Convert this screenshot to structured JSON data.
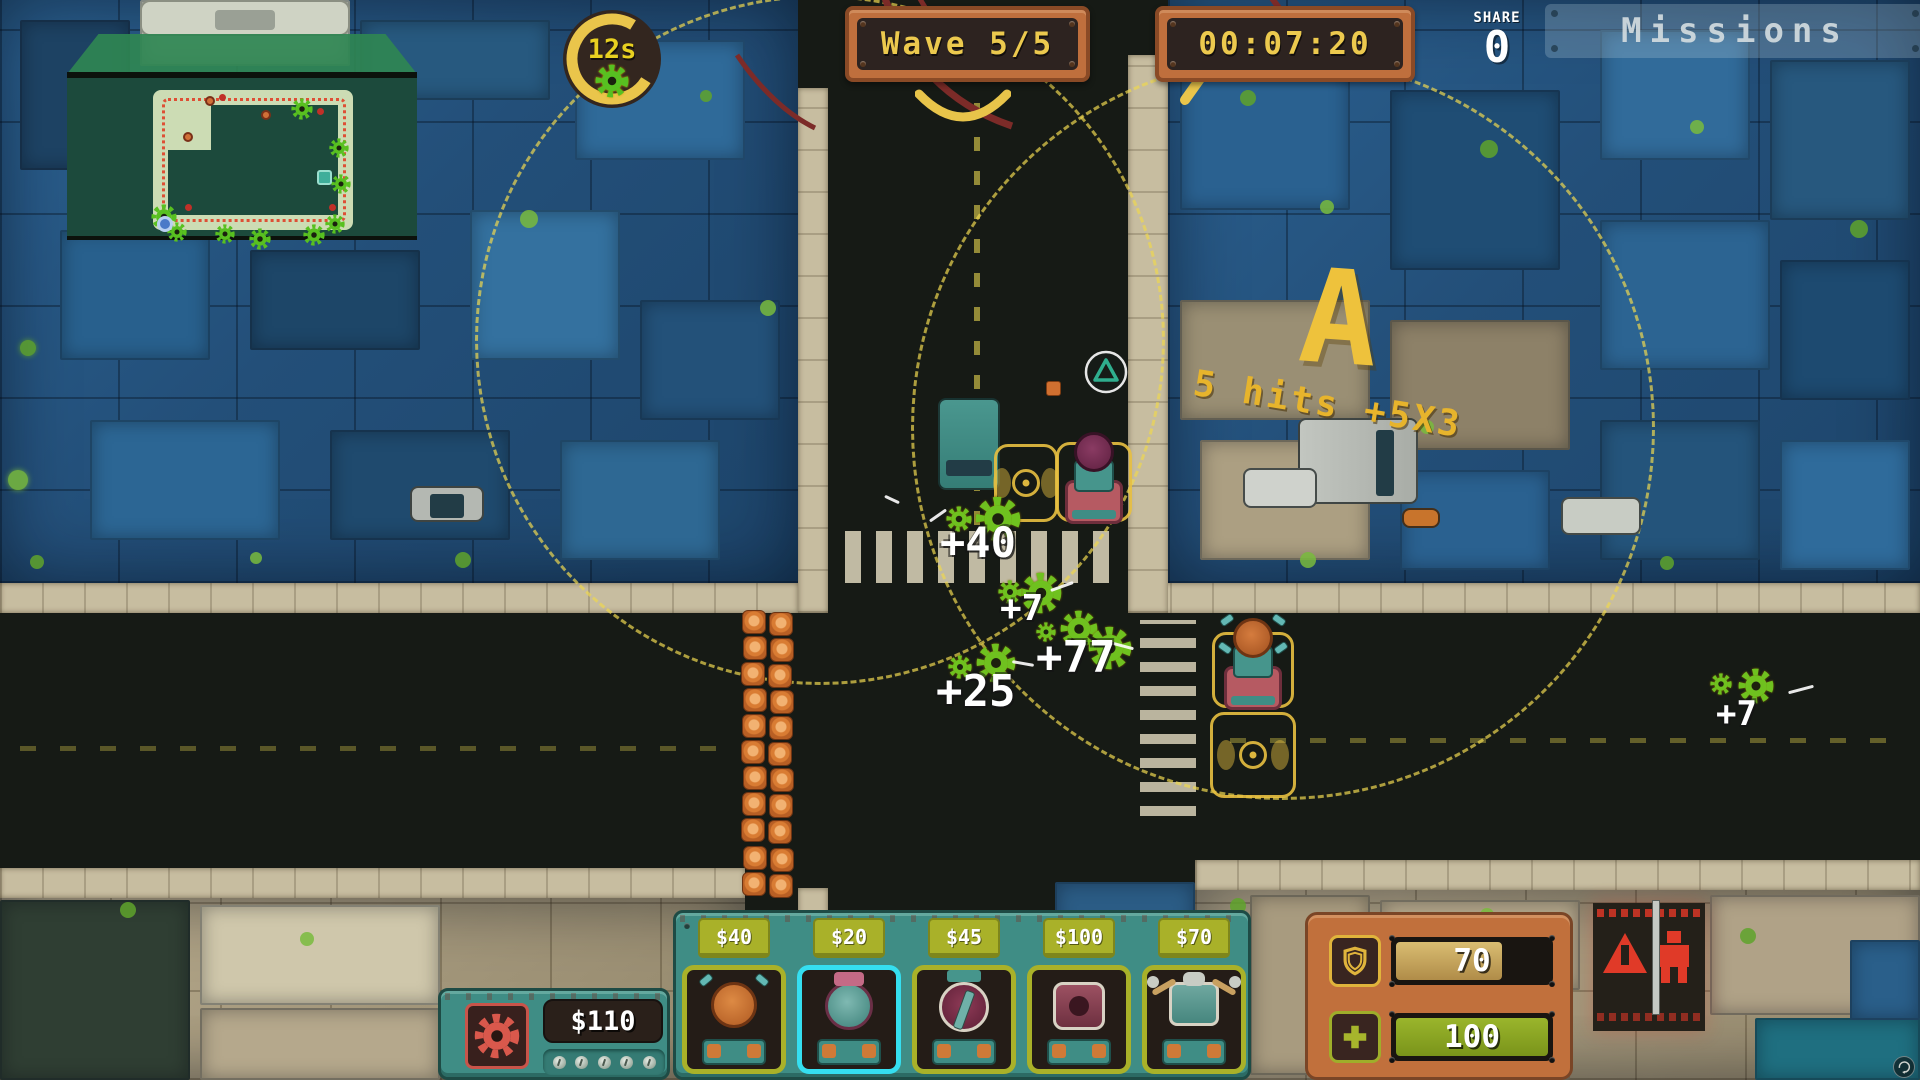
{
  "hud": {
    "wave_banner": {
      "label": "Wave 5/5"
    },
    "time_banner": {
      "value": "00:07:20"
    },
    "wave_timer": {
      "value": "12s",
      "progress_percent": 75
    },
    "share": {
      "label": "SHARE",
      "value": "0"
    },
    "missions": {
      "label": "Missions"
    },
    "money_panel": {
      "amount": "$110"
    },
    "shop": {
      "items": [
        {
          "price": "$40",
          "selected": false
        },
        {
          "price": "$20",
          "selected": true
        },
        {
          "price": "$45",
          "selected": false
        },
        {
          "price": "$100",
          "selected": false
        },
        {
          "price": "$70",
          "selected": false
        }
      ]
    },
    "status": {
      "shield": {
        "value": "70",
        "percent": 70
      },
      "health": {
        "value": "100",
        "percent": 100
      }
    }
  },
  "combat": {
    "combo": {
      "grade": "A",
      "detail": "5 hits +5X3"
    },
    "damage_numbers": [
      {
        "text": "+40"
      },
      {
        "text": "+7"
      },
      {
        "text": "+77"
      },
      {
        "text": "+25"
      },
      {
        "text": "+7"
      }
    ]
  },
  "colors": {
    "accent_yellow": "#eac54b",
    "panel_orange": "#bf6f3d",
    "panel_teal": "#3f8d85",
    "price_olive": "#a9b129",
    "selected_cyan": "#35dff0",
    "enemy_green": "#6fc11f",
    "danger_red": "#d9584c"
  }
}
